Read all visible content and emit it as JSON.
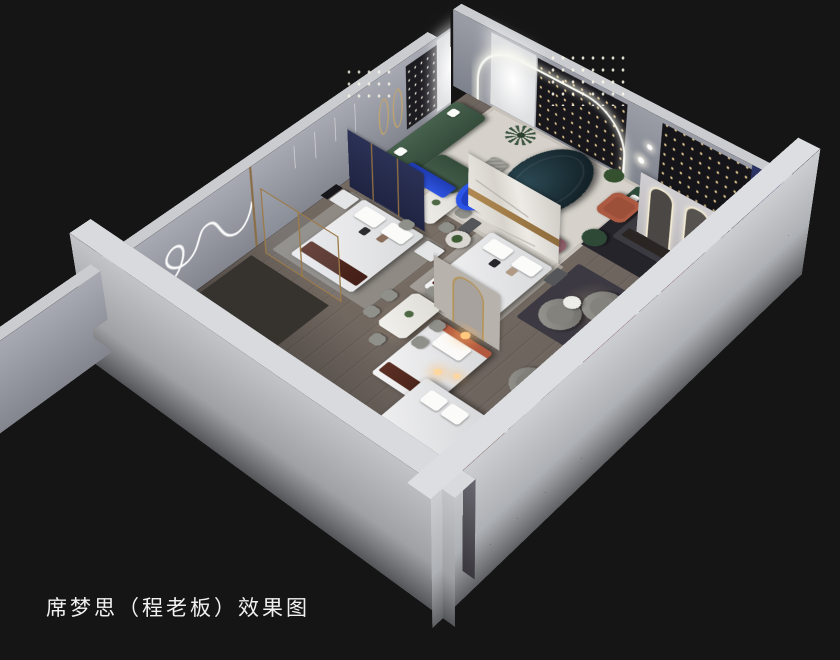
{
  "scene": {
    "caption": "席梦思（程老板）效果图",
    "render_type": "isometric cutaway interior rendering",
    "subject": "mattress brand showroom with bedroom, dining and lounge displays",
    "palette": {
      "background": "#151515",
      "outer_wall": "#c6c8cb",
      "inner_wall": "#9a9da8",
      "floor_wood": "#6e655e",
      "accent_blue": "#2b55e8",
      "sofa_green": "#3f5a46",
      "sofa_teal": "#1d333c",
      "mattress_brown": "#562b21",
      "headboard_navy": "#252b4d",
      "gold_trim": "#a8834f",
      "terracotta": "#ad5a42",
      "mauve_bench": "#986570",
      "led_white": "#f7f7f2",
      "lamp_warm": "#ffc87f"
    }
  }
}
